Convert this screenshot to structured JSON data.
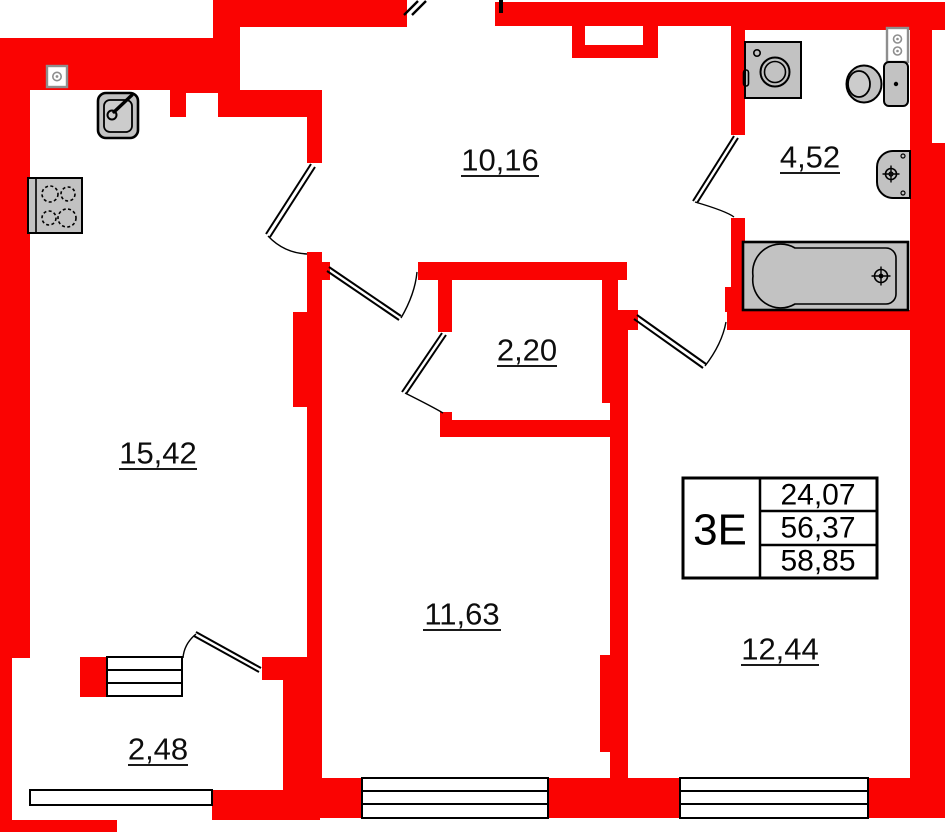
{
  "floor_plan": {
    "colors": {
      "wall": "#fa0302",
      "fixture_fill": "#c2c2c2",
      "line": "#000000",
      "background": "#ffffff"
    },
    "rooms": [
      {
        "name": "hall",
        "area": "10,16"
      },
      {
        "name": "bathroom",
        "area": "4,52"
      },
      {
        "name": "closet",
        "area": "2,20"
      },
      {
        "name": "kitchen-living",
        "area": "15,42"
      },
      {
        "name": "room-middle",
        "area": "11,63"
      },
      {
        "name": "room-right",
        "area": "12,44"
      },
      {
        "name": "balcony",
        "area": "2,48"
      }
    ],
    "info_table": {
      "type_label": "3Е",
      "living_area": "24,07",
      "apartment_area": "56,37",
      "total_area": "58,85"
    }
  }
}
